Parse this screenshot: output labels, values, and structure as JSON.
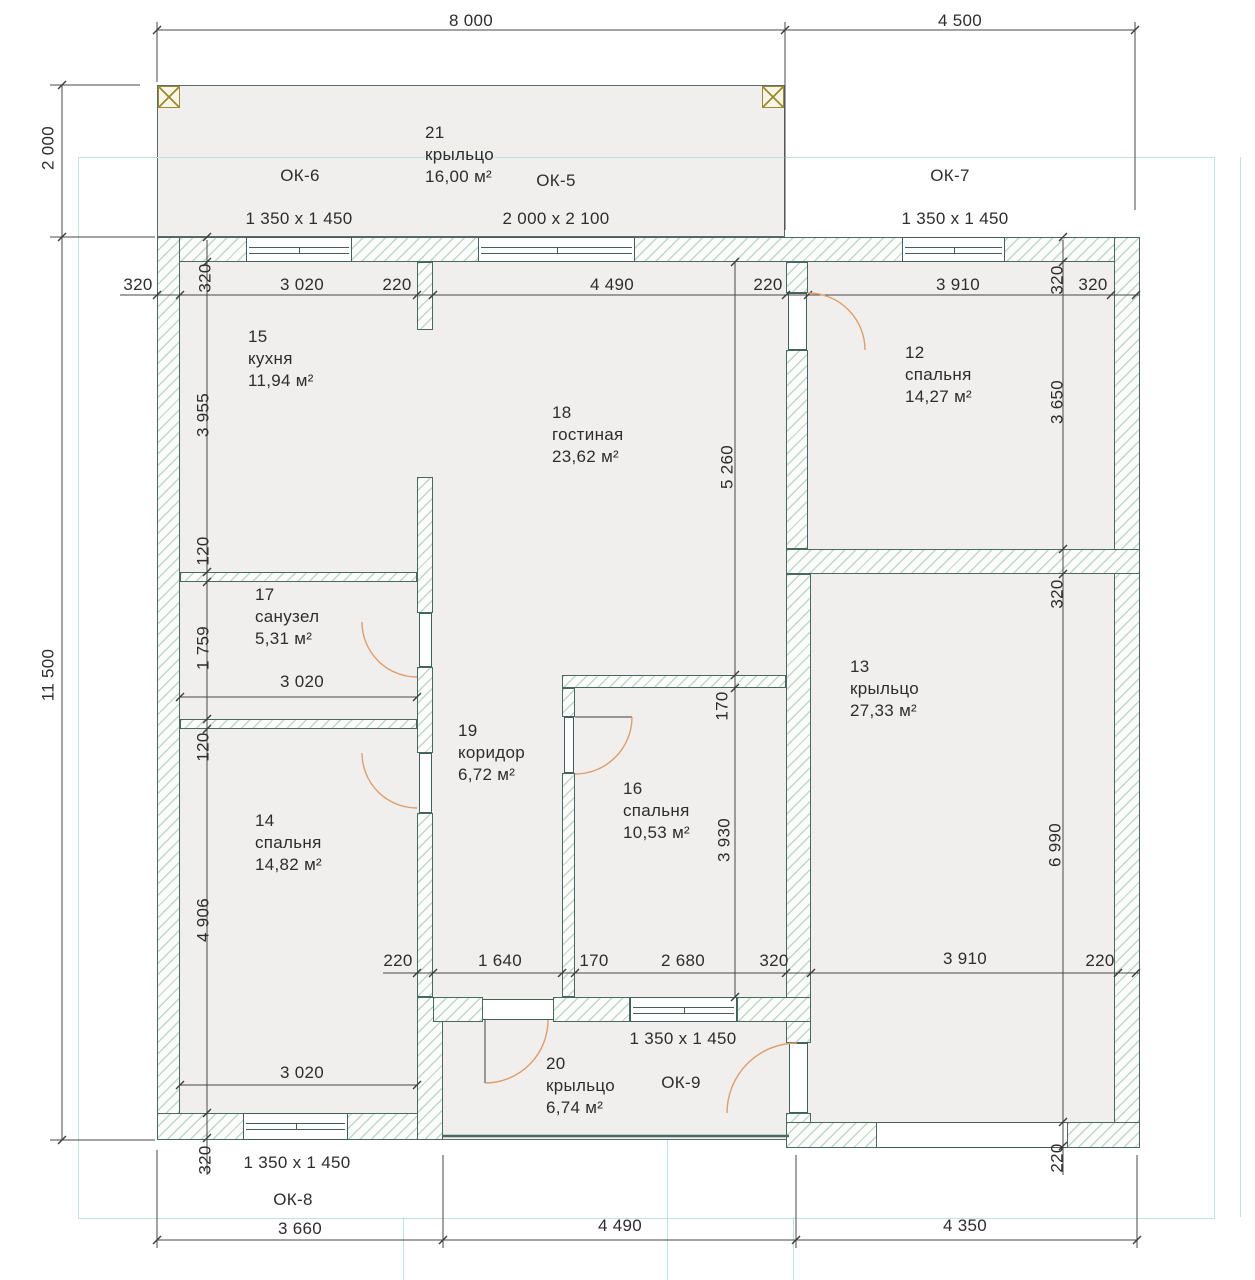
{
  "dims": [
    "8 000",
    "4 500",
    "320",
    "320",
    "3 020",
    "220",
    "4 490",
    "220",
    "3 910",
    "320",
    "320",
    "2 000",
    "11 500",
    "3 955",
    "120",
    "1 759",
    "120",
    "4 906",
    "320",
    "3 650",
    "320",
    "6 990",
    "220",
    "5 260",
    "170",
    "3 930",
    "3 020",
    "3 020",
    "220",
    "1 640",
    "170",
    "2 680",
    "320",
    "3 910",
    "220",
    "3 660",
    "4 490",
    "4 350"
  ],
  "windows": [
    "ОК-6",
    "1 350 x 1 450",
    "ОК-5",
    "2 000 x 2 100",
    "ОК-7",
    "1 350 x 1 450",
    "ОК-9",
    "1 350 x 1 450",
    "ОК-8",
    "1 350 x 1 450"
  ],
  "rooms": [
    {
      "num": "21",
      "name": "крыльцо",
      "area": "16,00 м²"
    },
    {
      "num": "15",
      "name": "кухня",
      "area": "11,94 м²"
    },
    {
      "num": "18",
      "name": "гостиная",
      "area": "23,62 м²"
    },
    {
      "num": "12",
      "name": "спальня",
      "area": "14,27 м²"
    },
    {
      "num": "17",
      "name": "санузел",
      "area": "5,31 м²"
    },
    {
      "num": "19",
      "name": "коридор",
      "area": "6,72 м²"
    },
    {
      "num": "16",
      "name": "спальня",
      "area": "10,53 м²"
    },
    {
      "num": "14",
      "name": "спальня",
      "area": "14,82 м²"
    },
    {
      "num": "13",
      "name": "крыльцо",
      "area": "27,33 м²"
    },
    {
      "num": "20",
      "name": "крыльцо",
      "area": "6,74 м²"
    }
  ],
  "colors": {
    "wall_outline": "#4a6862",
    "hatch": "#9cc3ab",
    "floor": "#f1efee",
    "dim_text": "#2d2d2d",
    "door_arc": "#dd9e6b",
    "grid_guide": "#bfe3df",
    "column_accent": "#9a8a33"
  }
}
